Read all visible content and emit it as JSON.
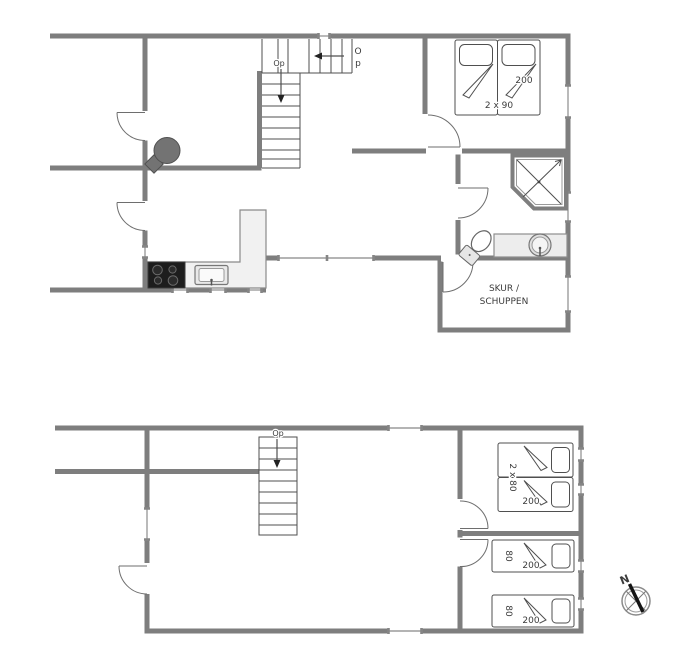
{
  "document": {
    "type": "floor-plan",
    "floors": 2
  },
  "palette": {
    "wall_color": "#7e7e7e",
    "line_color": "#4f4f4f",
    "window_color": "#9c9c9c",
    "counter_fill": "#f1f1f1",
    "stove_fill": "#1d1d1d",
    "wood_stove_fill": "#737373",
    "background": "#ffffff",
    "text_color": "#3b3b3b"
  },
  "upper_floor": {
    "stairs": {
      "up_label_char1": "O",
      "up_label_char2": "p",
      "down_label": "Op"
    },
    "bedroom": {
      "bed_length_label": "200",
      "bed_size_label": "2 x 90"
    },
    "shed": {
      "name_line1": "SKUR /",
      "name_line2": "SCHUPPEN"
    }
  },
  "lower_floor": {
    "stairs": {
      "label": "Op"
    },
    "bedroom_double": {
      "bed_size_label": "2 x 80",
      "bed_length_label": "200"
    },
    "bedroom_middle": {
      "bed_width_label": "80",
      "bed_length_label": "200"
    },
    "bedroom_bottom": {
      "bed_width_label": "80",
      "bed_length_label": "200"
    }
  },
  "compass": {
    "north_label": "N"
  }
}
